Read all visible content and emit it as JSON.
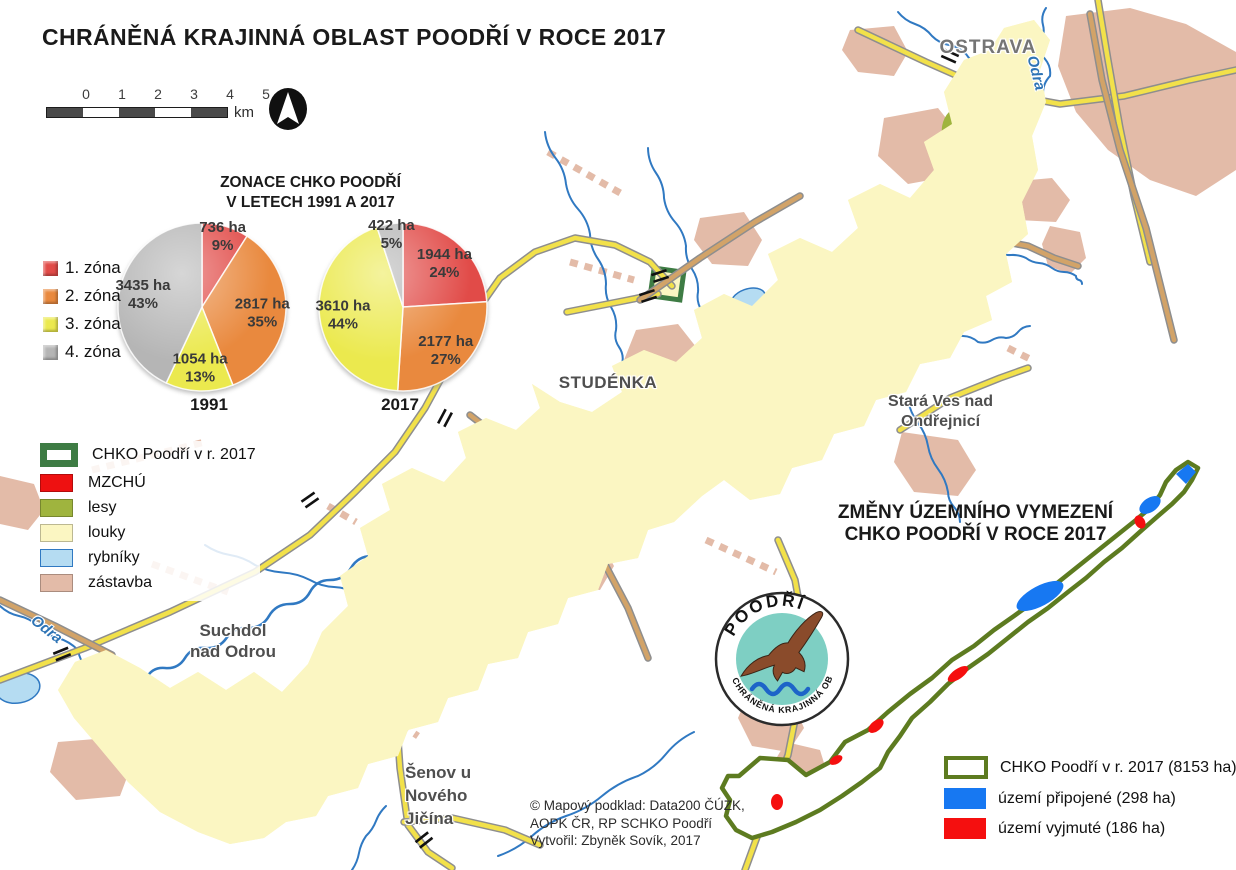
{
  "title": "CHRÁNĚNÁ KRAJINNÁ OBLAST POODŘÍ V ROCE 2017",
  "scale_bar": {
    "ticks": [
      "0",
      "1",
      "2",
      "3",
      "4",
      "5"
    ],
    "unit": "km"
  },
  "zonation": {
    "title_line1": "ZONACE CHKO POODŘÍ",
    "title_line2": "V LETECH 1991 A 2017",
    "legend": [
      {
        "label": "1. zóna",
        "color": "#E14B48"
      },
      {
        "label": "2. zóna",
        "color": "#E9893E"
      },
      {
        "label": "3. zóna",
        "color": "#EBE94E"
      },
      {
        "label": "4. zóna",
        "color": "#B5B5B5"
      }
    ]
  },
  "chart_data": [
    {
      "type": "pie",
      "title": "1991",
      "categories": [
        "1. zóna",
        "2. zóna",
        "3. zóna",
        "4. zóna"
      ],
      "values_ha": [
        736,
        2817,
        1054,
        3435
      ],
      "percents": [
        9,
        35,
        13,
        43
      ],
      "unit": "ha",
      "legend_position": "left",
      "start_angle": "12 o'clock clockwise"
    },
    {
      "type": "pie",
      "title": "2017",
      "categories": [
        "1. zóna",
        "2. zóna",
        "3. zóna",
        "4. zóna"
      ],
      "values_ha": [
        1944,
        2177,
        3610,
        422
      ],
      "percents": [
        24,
        27,
        44,
        5
      ],
      "unit": "ha",
      "legend_position": "left",
      "start_angle": "12 o'clock clockwise"
    }
  ],
  "map_legend": {
    "items": [
      {
        "label": "CHKO Poodří v r. 2017",
        "swatch": "outline",
        "color": "#3E7C44"
      },
      {
        "label": "MZCHÚ",
        "swatch": "fill",
        "color": "#EE1111"
      },
      {
        "label": "lesy",
        "swatch": "fill",
        "color": "#9FB43E"
      },
      {
        "label": "louky",
        "swatch": "fill",
        "color": "#FBF6C2"
      },
      {
        "label": "rybníky",
        "swatch": "fill",
        "color": "#B5DCF2",
        "border": "#3079C2"
      },
      {
        "label": "zástavba",
        "swatch": "fill",
        "color": "#E3BBA8"
      }
    ]
  },
  "place_labels": {
    "ostrava": "OSTRAVA",
    "odra_top": "Odra",
    "studenka": "STUDÉNKA",
    "stara_ves_1": "Stará Ves nad",
    "stara_ves_2": "Ondřejnicí",
    "suchdol_1": "Suchdol",
    "suchdol_2": "nad Odrou",
    "senov_1": "Šenov u",
    "senov_2": "Nového",
    "senov_3": "Jičína",
    "odra_left": "Odra"
  },
  "inset": {
    "title_line1": "ZMĚNY ÚZEMNÍHO VYMEZENÍ",
    "title_line2": "CHKO POODŘÍ V ROCE 2017",
    "legend": [
      {
        "label": "CHKO Poodří v r. 2017 (8153 ha)",
        "swatch": "outline",
        "color": "#5D7B20"
      },
      {
        "label": "území připojené (298 ha)",
        "swatch": "fill",
        "color": "#1778F2"
      },
      {
        "label": "území vyjmuté (186 ha)",
        "swatch": "fill",
        "color": "#F50F0F"
      }
    ]
  },
  "logo": {
    "top_text": "POODŘÍ",
    "bottom_text": "CHRÁNĚNÁ KRAJINNÁ OBLAST"
  },
  "credits": [
    "© Mapový podklad: Data200 ČÚZK,",
    "AOPK ČR, RP SCHKO Poodří",
    "Vytvořil: Zbyněk Sovík, 2017"
  ],
  "palette": {
    "boundary": "#3E7C44",
    "louky": "#FBF6C2",
    "lesy": "#9FB43E",
    "pond": "#B5DCF2",
    "water": "#3079C2",
    "mzchu": "#CC4D5A",
    "mzchu_border": "#A32D3C",
    "orange_patch": "#C9581F",
    "orange_light": "#E2704F",
    "zastavba": "#E3BBA8",
    "road_yellow": "#F2E14A",
    "road_casing": "#8E8E8E",
    "road_tan": "#D2A368",
    "rail": "#111111",
    "inset_outline": "#5D7B20",
    "inset_blue": "#1778F2",
    "inset_red": "#F50F0F",
    "logo_teal": "#7ECFC3",
    "logo_eagle": "#8A4B2B",
    "logo_wave": "#1D64C8"
  }
}
